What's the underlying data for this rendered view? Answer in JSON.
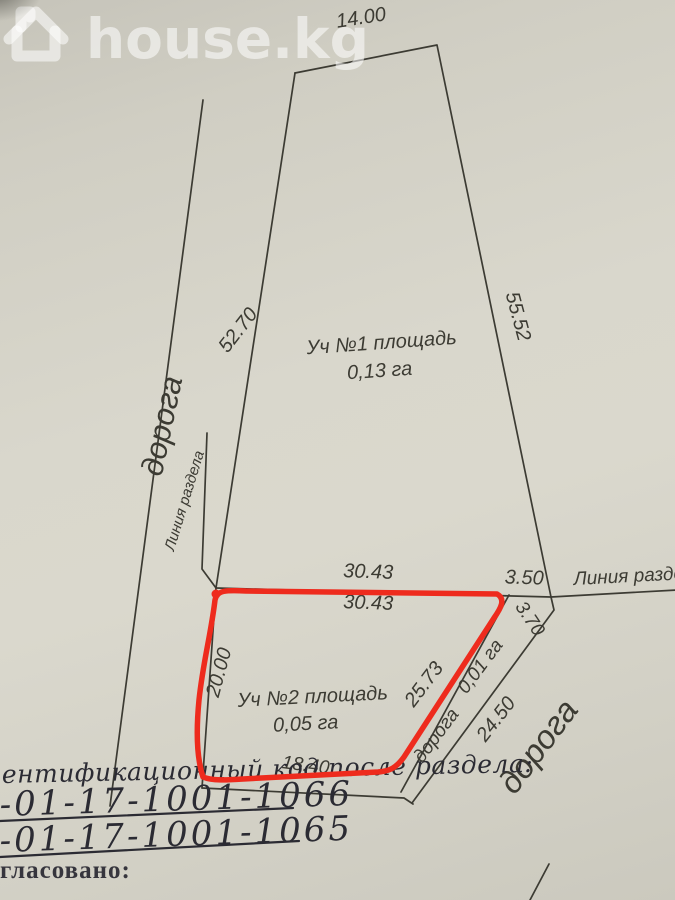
{
  "watermark": {
    "brand": "house.kg"
  },
  "plan": {
    "outer": {
      "top": "14.00",
      "left": "52.70",
      "right": "55.52"
    },
    "plot1": {
      "title": "Уч №1 площадь",
      "area": "0,13 га"
    },
    "plot2": {
      "title": "Уч №2 площадь",
      "area": "0,05 га",
      "top": "30.43",
      "left": "20.00",
      "diagonal": "25.73",
      "bottom": "18.40"
    },
    "division": {
      "left_label": "Линия раздела",
      "right_label": "Линия раздела",
      "top_length": "30.43",
      "right_length": "3.50"
    },
    "road_left": {
      "label": "дорога"
    },
    "road_strip": {
      "label": "дорога",
      "area": "0,01 га",
      "inner_length": "3.70",
      "outer_length": "24.50"
    },
    "road_right": {
      "label": "дорога"
    }
  },
  "handwriting": {
    "line1": "ентификационный код после раздела:",
    "code1": "-01-17-1001-1066",
    "code2": "-01-17-1001-1065"
  },
  "footer": {
    "label": "гласовано:"
  }
}
